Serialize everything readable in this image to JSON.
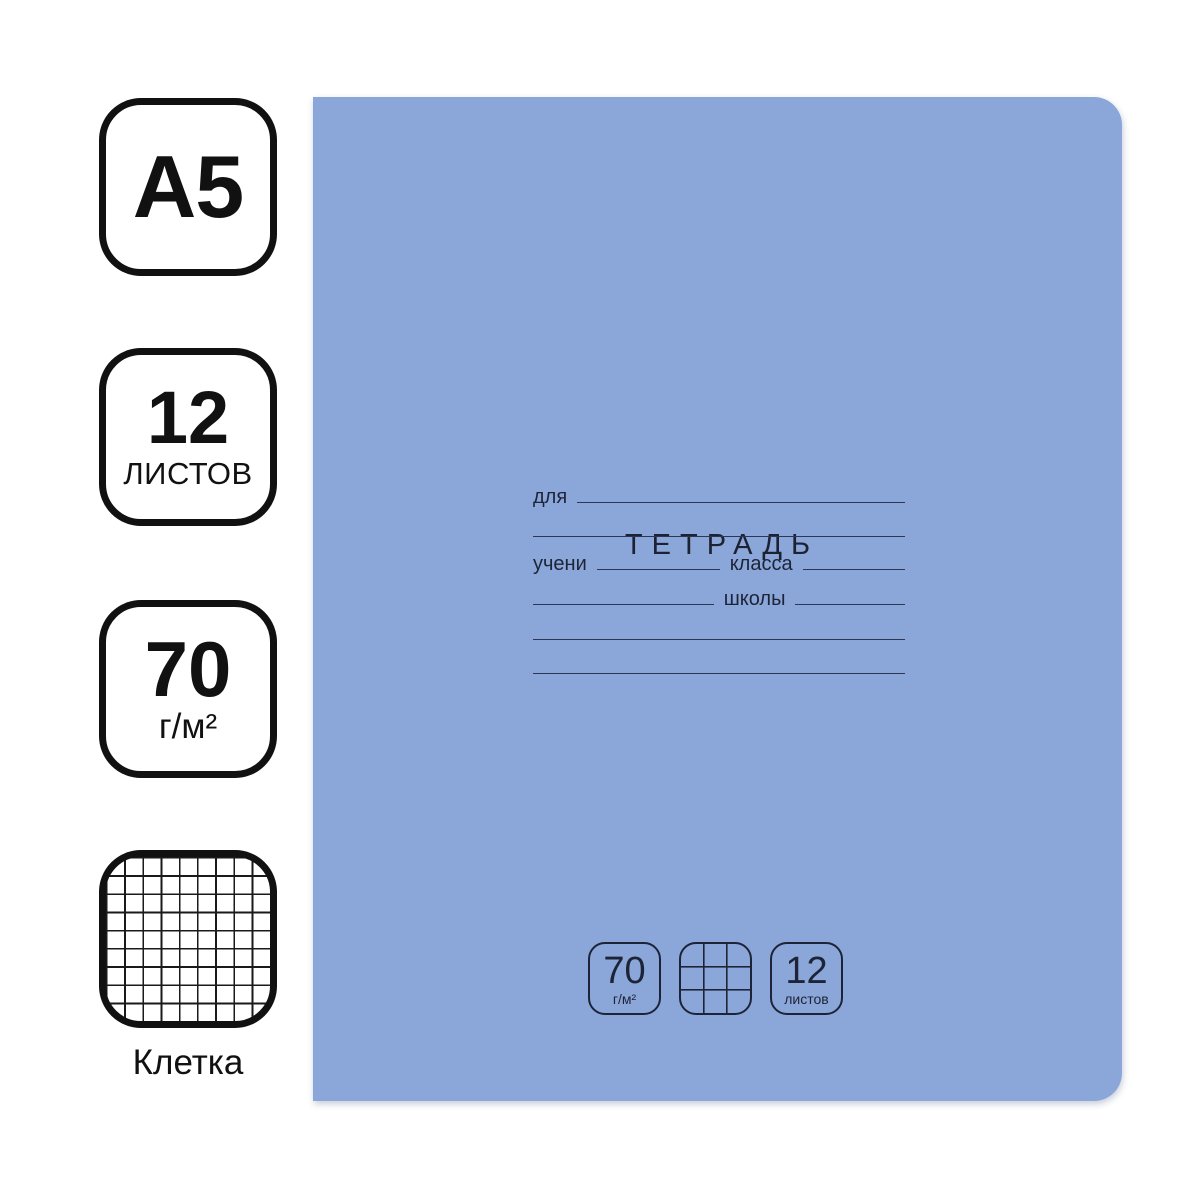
{
  "colors": {
    "page_background": "#ffffff",
    "cover_blue": "#8ba6d9",
    "cover_ink": "#1d2437",
    "badge_ink": "#111111"
  },
  "left_panel": {
    "format_badge": {
      "label": "А5"
    },
    "sheets_badge": {
      "value": "12",
      "unit": "ЛИСТОВ"
    },
    "density_badge": {
      "value": "70",
      "unit": "г/м²"
    },
    "ruling_badge": {
      "icon": "grid-icon",
      "label": "Клетка"
    }
  },
  "cover": {
    "title": "ТЕТРАДЬ",
    "form": {
      "for_label": "для",
      "student_label": "учени",
      "class_label": "класса",
      "school_label": "школы"
    },
    "spec_badges": {
      "density": {
        "value": "70",
        "unit": "г/м²"
      },
      "ruling": {
        "icon": "grid-icon"
      },
      "sheets": {
        "value": "12",
        "unit": "листов"
      }
    }
  }
}
